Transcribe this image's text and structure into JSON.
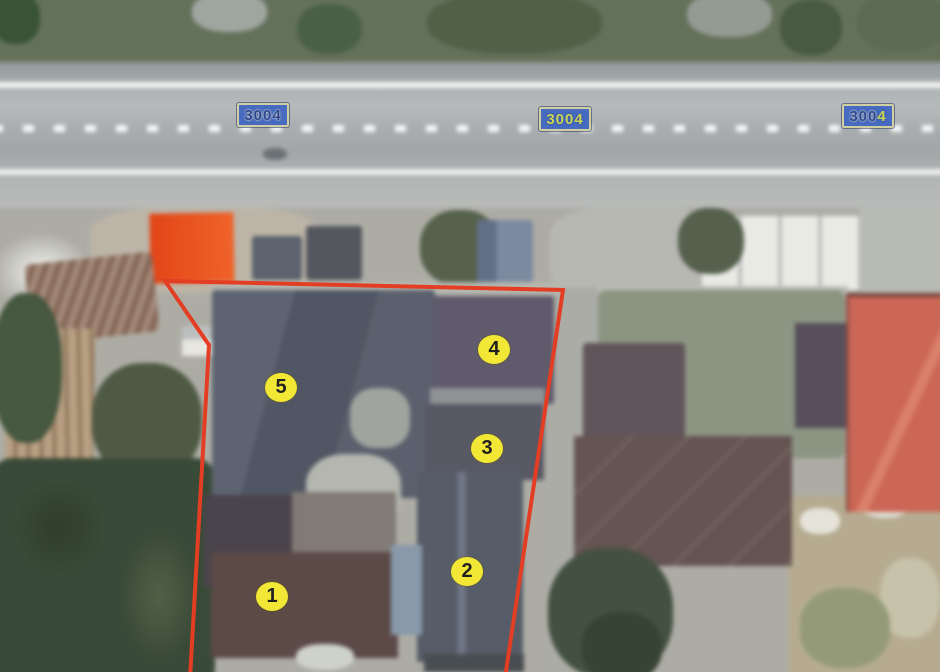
{
  "map": {
    "route_badges": [
      {
        "label": "3004"
      },
      {
        "label": "3004"
      },
      {
        "label": "3004",
        "part1": "300",
        "part2": "4"
      }
    ],
    "badge_colors": {
      "background": "#3c63bd",
      "border": "#cfcd9b",
      "text_navy": "#22398e",
      "text_yellow": "#c9d24c"
    },
    "parcel": {
      "points": "190,678 209,345 165,281 563,290 505,678",
      "outline_color": "#e23318"
    },
    "markers": [
      {
        "label": "1"
      },
      {
        "label": "2"
      },
      {
        "label": "3"
      },
      {
        "label": "4"
      },
      {
        "label": "5"
      }
    ],
    "marker_colors": {
      "fill": "#f1e62b",
      "text": "#151515"
    }
  }
}
